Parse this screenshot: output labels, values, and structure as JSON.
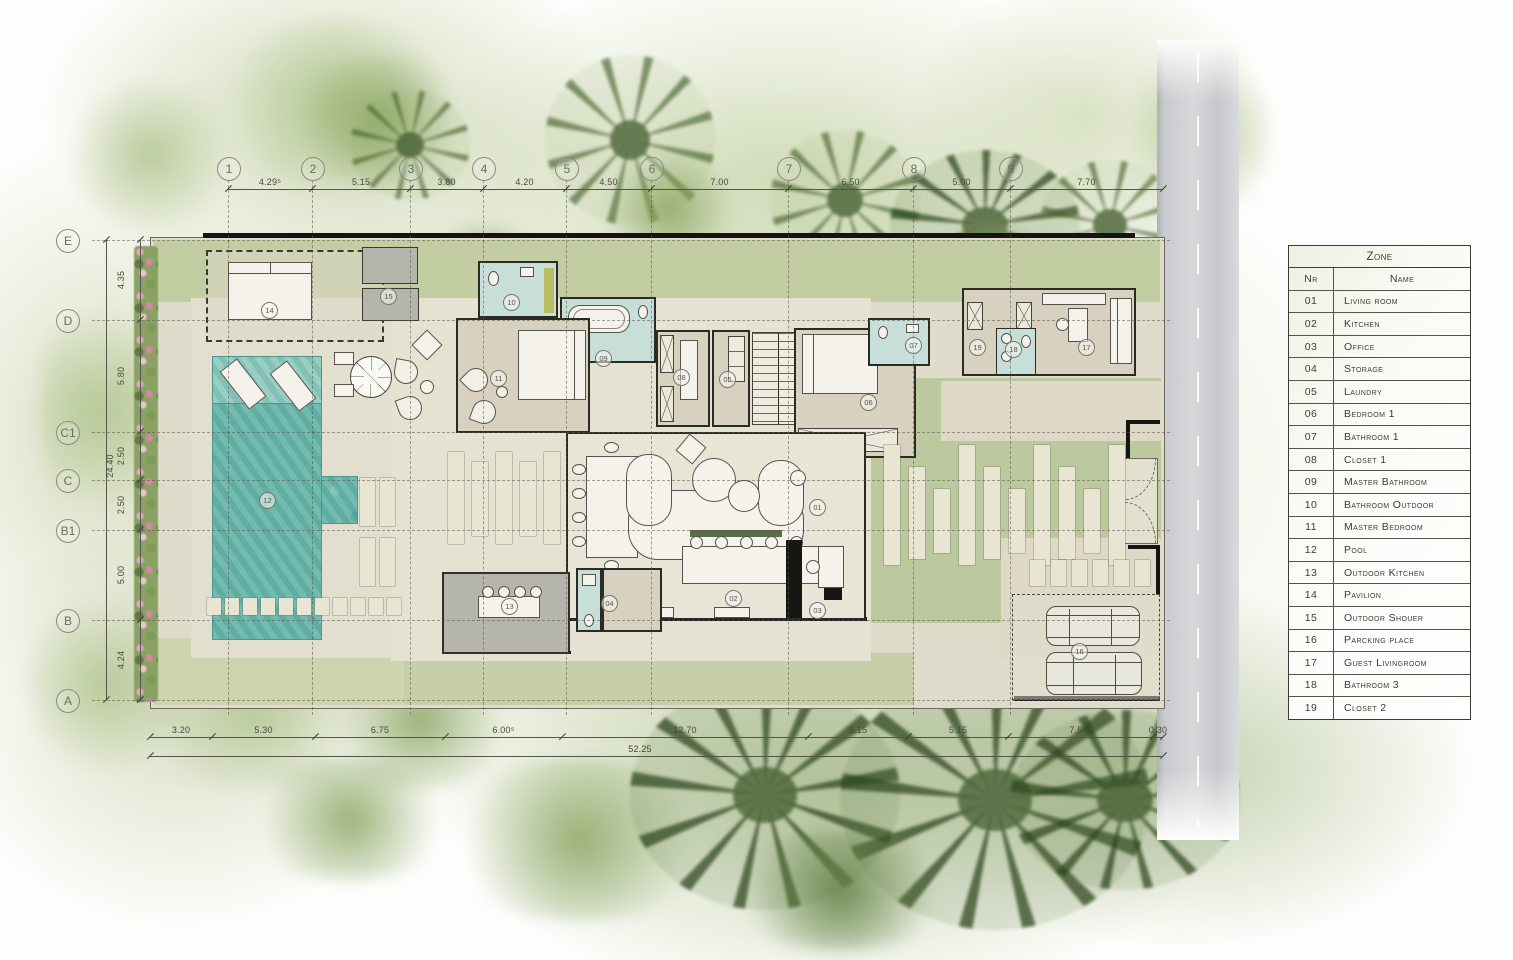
{
  "legend": {
    "title": "Zone",
    "col_nr": "Nr",
    "col_name": "Name",
    "rows": [
      {
        "nr": "01",
        "name": "Living room"
      },
      {
        "nr": "02",
        "name": "Kitchen"
      },
      {
        "nr": "03",
        "name": "Office"
      },
      {
        "nr": "04",
        "name": "Storage"
      },
      {
        "nr": "05",
        "name": "Laundry"
      },
      {
        "nr": "06",
        "name": "Bedroom 1"
      },
      {
        "nr": "07",
        "name": "Bathroom 1"
      },
      {
        "nr": "08",
        "name": "Closet 1"
      },
      {
        "nr": "09",
        "name": "Master Bathroom"
      },
      {
        "nr": "10",
        "name": "Bathroom Outdoor"
      },
      {
        "nr": "11",
        "name": "Master Bedroom"
      },
      {
        "nr": "12",
        "name": "Pool"
      },
      {
        "nr": "13",
        "name": "Outdoor Kitchen"
      },
      {
        "nr": "14",
        "name": "Pavilion"
      },
      {
        "nr": "15",
        "name": "Outdoor Shouer"
      },
      {
        "nr": "16",
        "name": "Parcking place"
      },
      {
        "nr": "17",
        "name": "Guest Livingroom"
      },
      {
        "nr": "18",
        "name": "Bathroom 3"
      },
      {
        "nr": "19",
        "name": "Closet 2"
      }
    ]
  },
  "grid": {
    "top": [
      {
        "label": "1",
        "x": 228
      },
      {
        "label": "2",
        "x": 312
      },
      {
        "label": "3",
        "x": 410
      },
      {
        "label": "4",
        "x": 483
      },
      {
        "label": "5",
        "x": 566
      },
      {
        "label": "6",
        "x": 651
      },
      {
        "label": "7",
        "x": 788
      },
      {
        "label": "8",
        "x": 913
      },
      {
        "label": "9",
        "x": 1010
      }
    ],
    "left": [
      {
        "label": "E",
        "y": 240
      },
      {
        "label": "D",
        "y": 320
      },
      {
        "label": "C1",
        "y": 432
      },
      {
        "label": "C",
        "y": 480
      },
      {
        "label": "B1",
        "y": 530
      },
      {
        "label": "B",
        "y": 620
      },
      {
        "label": "A",
        "y": 700
      }
    ]
  },
  "dimensions": {
    "top": {
      "xs": [
        228,
        312,
        410,
        483,
        566,
        651,
        788,
        913,
        1010,
        1163
      ],
      "labels": [
        "4.29⁵",
        "5.15",
        "3.80",
        "4.20",
        "4.50",
        "7.00",
        "6.50",
        "5.00",
        "7.70"
      ]
    },
    "bottom": {
      "xs": [
        150,
        212,
        315,
        445,
        562,
        808,
        908,
        1008,
        1153,
        1163
      ],
      "labels": [
        "3.20",
        "5.30",
        "6.75",
        "6.00⁵",
        "12.70",
        "5.15",
        "5.15",
        "7.50⁵",
        "0.30"
      ],
      "total": "52.25"
    },
    "left": {
      "ys": [
        240,
        320,
        432,
        480,
        530,
        620,
        700
      ],
      "labels": [
        "4.35",
        "5.80",
        "2.50",
        "2.50",
        "5.00",
        "4.24"
      ],
      "total": "24.40"
    }
  },
  "rooms": [
    {
      "nr": "01",
      "x": 817,
      "y": 507
    },
    {
      "nr": "02",
      "x": 733,
      "y": 598
    },
    {
      "nr": "03",
      "x": 817,
      "y": 610
    },
    {
      "nr": "04",
      "x": 609,
      "y": 603
    },
    {
      "nr": "05",
      "x": 727,
      "y": 379
    },
    {
      "nr": "06",
      "x": 868,
      "y": 402
    },
    {
      "nr": "07",
      "x": 913,
      "y": 345
    },
    {
      "nr": "08",
      "x": 681,
      "y": 377
    },
    {
      "nr": "09",
      "x": 603,
      "y": 358
    },
    {
      "nr": "10",
      "x": 511,
      "y": 302
    },
    {
      "nr": "11",
      "x": 498,
      "y": 378
    },
    {
      "nr": "12",
      "x": 267,
      "y": 500
    },
    {
      "nr": "13",
      "x": 509,
      "y": 606
    },
    {
      "nr": "14",
      "x": 269,
      "y": 310
    },
    {
      "nr": "15",
      "x": 388,
      "y": 296
    },
    {
      "nr": "16",
      "x": 1079,
      "y": 651
    },
    {
      "nr": "17",
      "x": 1086,
      "y": 347
    },
    {
      "nr": "18",
      "x": 1013,
      "y": 349
    },
    {
      "nr": "19",
      "x": 977,
      "y": 347
    }
  ],
  "colors": {
    "pool": "#67b5aa",
    "bathroom_teal": "#c8ded8",
    "room_beige": "#d9d1bf",
    "terrace_cream": "#e9e5d6",
    "outdoor_kitchen_gray": "#b5b5ab",
    "lawn_green": "#c2cda2",
    "road_gray": "#cfd1d4",
    "line_dark": "#2b2b26"
  }
}
